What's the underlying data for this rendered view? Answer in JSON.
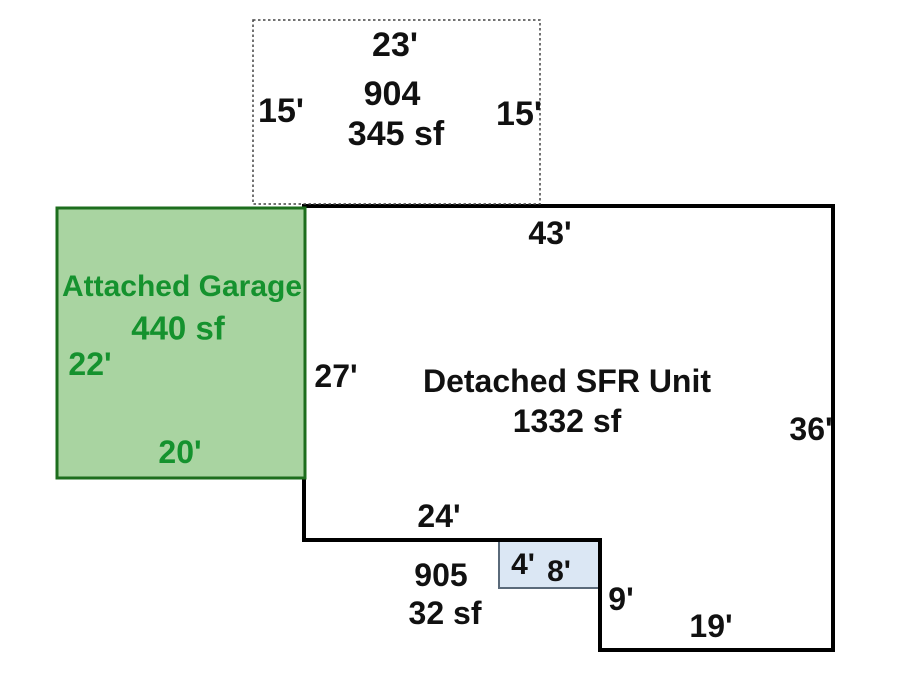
{
  "sketch": {
    "porch": {
      "id": "904",
      "area": "345 sf",
      "width_top": "23'",
      "height_left": "15'",
      "height_right": "15'"
    },
    "sfr": {
      "name": "Detached SFR Unit",
      "area": "1332 sf",
      "width_top": "43'",
      "height_left": "27'",
      "height_right": "36'",
      "width_notch": "24'",
      "step_height": "9'",
      "width_bottom": "19'"
    },
    "garage": {
      "name": "Attached Garage",
      "area": "440 sf",
      "height_left": "22'",
      "width_bottom": "20'"
    },
    "stoop": {
      "id": "905",
      "area": "32 sf",
      "height": "4'",
      "width": "8'"
    }
  },
  "colors": {
    "background": "#ffffff",
    "outline": "#000000",
    "porch_border": "#444444",
    "garage_fill": "#a9d4a1",
    "garage_border": "#1d6e1d",
    "garage_text": "#15922e",
    "stoop_fill": "#dbe7f4",
    "stoop_border": "#5a6a7a"
  }
}
